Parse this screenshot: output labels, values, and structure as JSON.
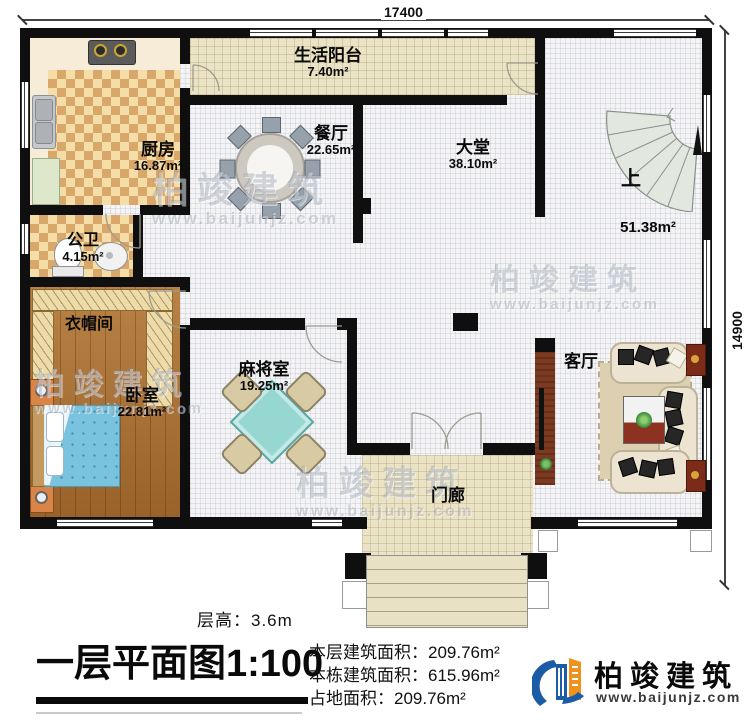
{
  "dimensions": {
    "top": "17400",
    "right": "14900"
  },
  "rooms": {
    "balcony": {
      "name": "生活阳台",
      "area": "7.40m²"
    },
    "kitchen": {
      "name": "厨房",
      "area": "16.87m²"
    },
    "dining": {
      "name": "餐厅",
      "area": "22.65m²"
    },
    "hall": {
      "name": "大堂",
      "area": "38.10m²"
    },
    "stair": {
      "up": "上",
      "area": "51.38m²"
    },
    "bathroom": {
      "name": "公卫",
      "area": "4.15m²"
    },
    "cloakroom": {
      "name": "衣帽间"
    },
    "bedroom": {
      "name": "卧室",
      "area": "22.81m²"
    },
    "mahjong": {
      "name": "麻将室",
      "area": "19.25m²"
    },
    "living": {
      "name": "客厅"
    },
    "porch": {
      "name": "门廊"
    }
  },
  "footer": {
    "floor_height": "层高：3.6m",
    "title": "一层平面图1:100",
    "floor_area": "本层建筑面积：209.76m²",
    "building_area": "本栋建筑面积：615.96m²",
    "land_area": "占地面积：209.76m²"
  },
  "brand": {
    "name": "柏竣建筑",
    "website": "www.baijunjz.com"
  },
  "watermark": {
    "name": "柏竣建筑",
    "website": "www.baijunjz.com"
  }
}
